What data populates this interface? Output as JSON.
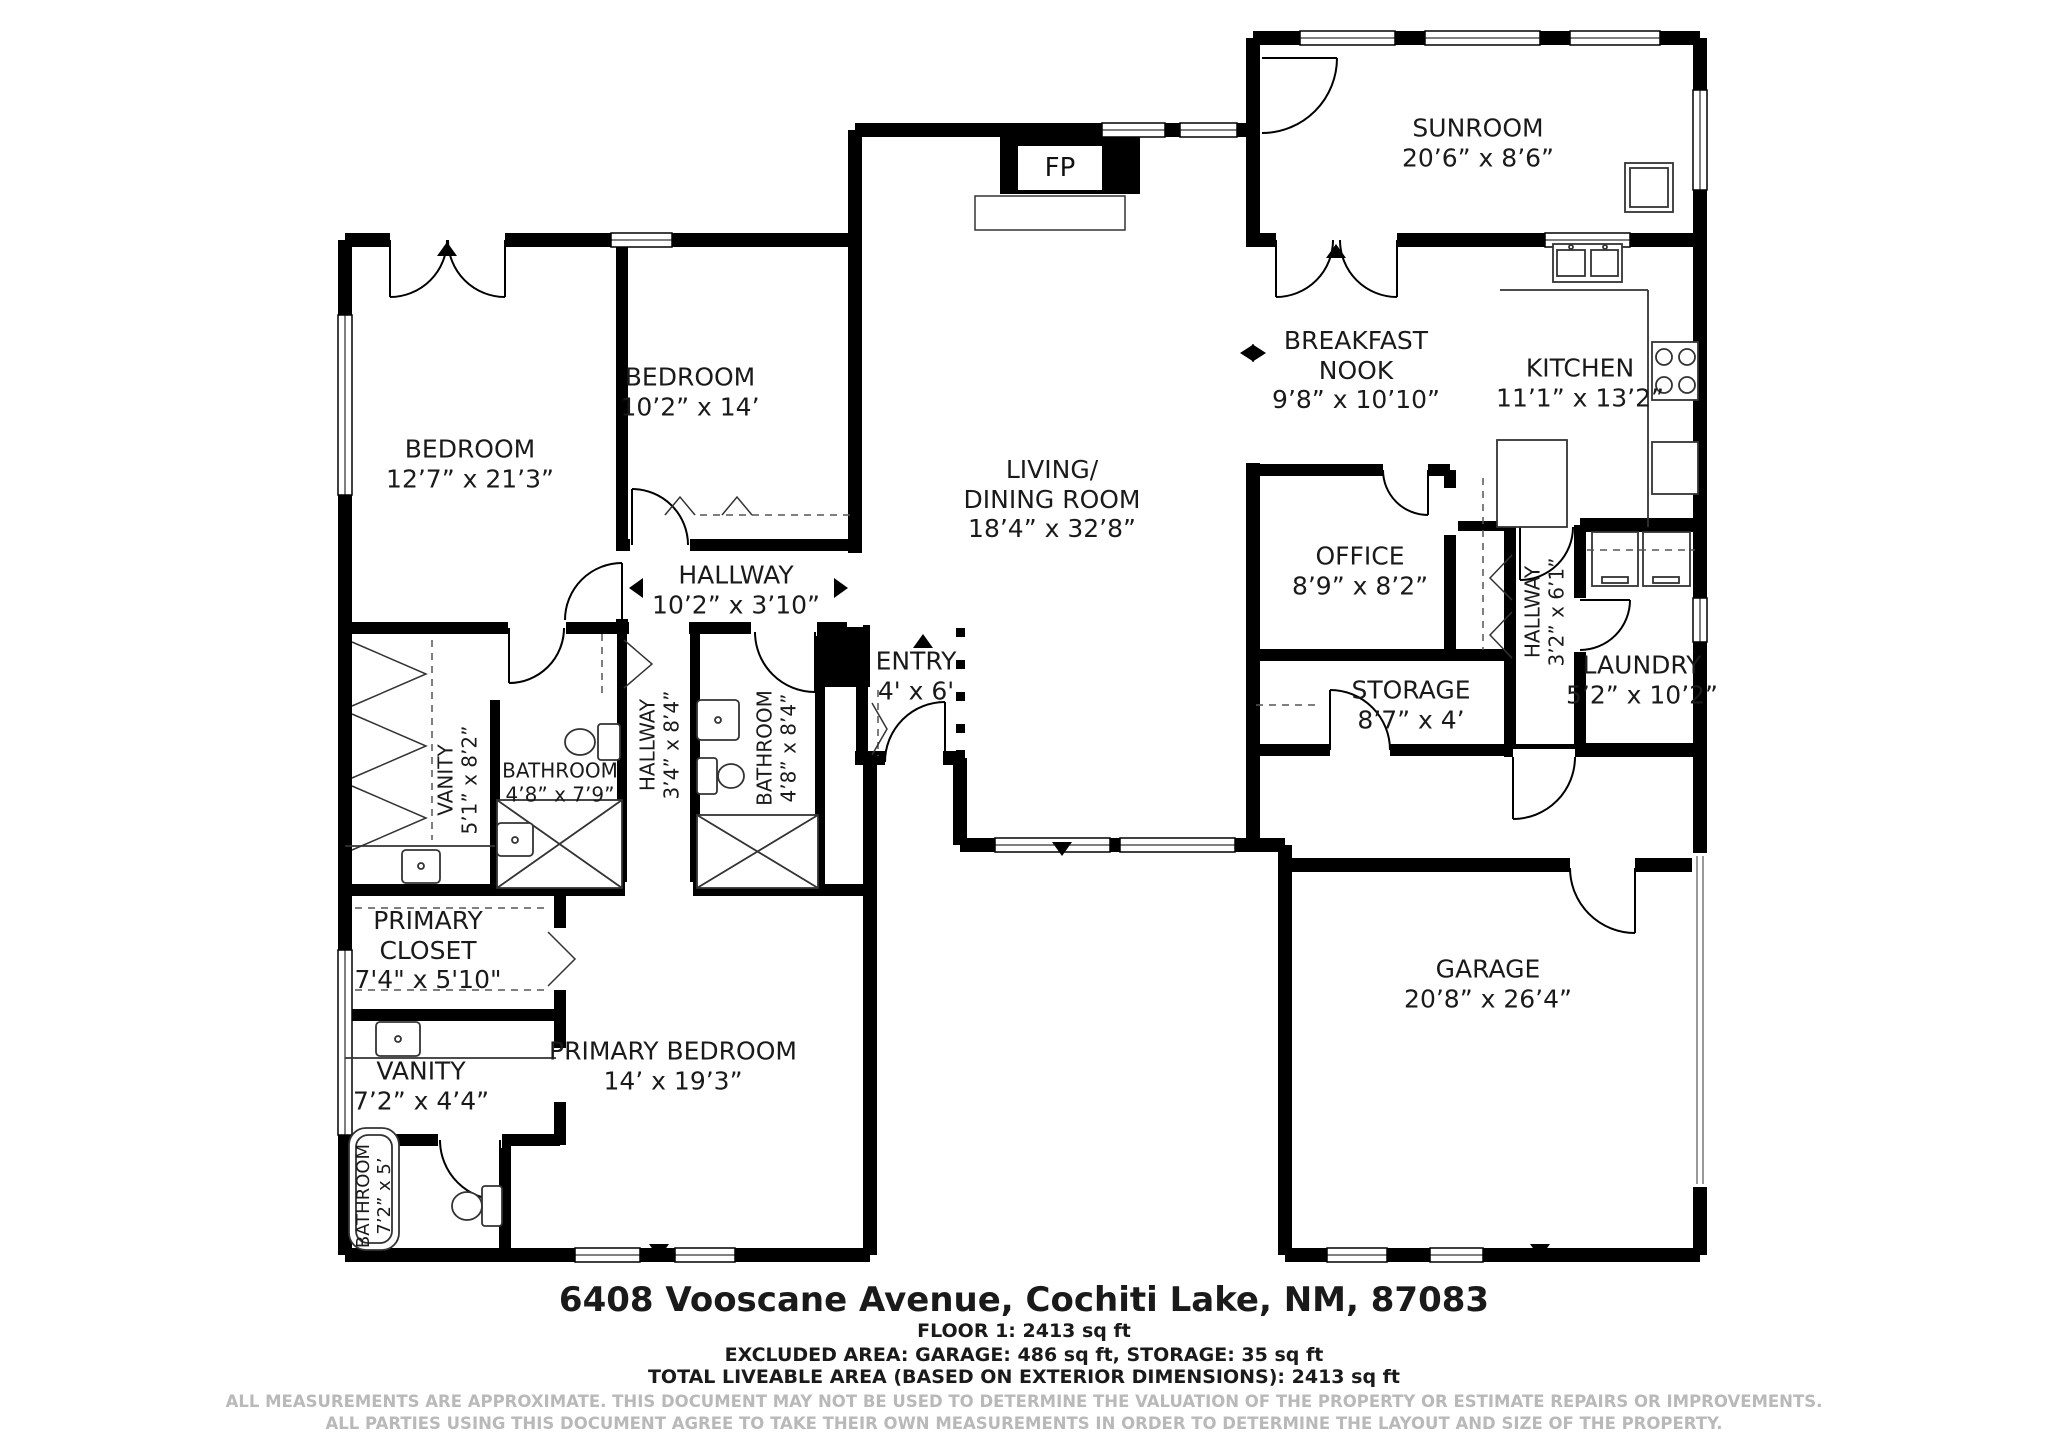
{
  "rooms": {
    "sunroom": {
      "line1": "SUNROOM",
      "dims": "20’6” x 8’6”"
    },
    "breakfast_nook": {
      "line1": "BREAKFAST",
      "line2": "NOOK",
      "dims": "9’8” x 10’10”"
    },
    "kitchen": {
      "line1": "KITCHEN",
      "dims": "11’1” x 13’2”"
    },
    "living_dining": {
      "line1": "LIVING/",
      "line2": "DINING ROOM",
      "dims": "18’4” x 32’8”"
    },
    "office": {
      "line1": "OFFICE",
      "dims": "8’9” x 8’2”"
    },
    "storage": {
      "line1": "STORAGE",
      "dims": "8’7” x 4’"
    },
    "hallway_right": {
      "line1": "HALLWAY",
      "dims": "3’2” x 6’1”"
    },
    "laundry": {
      "line1": "LAUNDRY",
      "dims": "5’2” x 10’2”"
    },
    "garage": {
      "line1": "GARAGE",
      "dims": "20’8” x 26’4”"
    },
    "bedroom_large": {
      "line1": "BEDROOM",
      "dims": "12’7” x 21’3”"
    },
    "bedroom_small": {
      "line1": "BEDROOM",
      "dims": "10’2” x 14’"
    },
    "hallway_main": {
      "line1": "HALLWAY",
      "dims": "10’2” x 3’10”"
    },
    "hallway_bath": {
      "line1": "HALLWAY",
      "dims": "3’4” x 8’4”"
    },
    "bathroom_hall": {
      "line1": "BATHROOM",
      "dims": "4’8” x 7’9”"
    },
    "bathroom_guest": {
      "line1": "BATHROOM",
      "dims": "4’8” x 8’4”"
    },
    "vanity_hall": {
      "line1": "VANITY",
      "dims": "5’1” x 8’2”"
    },
    "entry": {
      "line1": "ENTRY",
      "dims": "4' x 6'"
    },
    "primary_closet": {
      "line1": "PRIMARY",
      "line2": "CLOSET",
      "dims": "7'4\" x 5'10\""
    },
    "vanity_primary": {
      "line1": "VANITY",
      "dims": "7’2” x 4’4”"
    },
    "bathroom_primary": {
      "line1": "BATHROOM",
      "dims": "7’2” x 5’"
    },
    "primary_bedroom": {
      "line1": "PRIMARY BEDROOM",
      "dims": "14’ x 19’3”"
    }
  },
  "fireplace": {
    "label": "FP"
  },
  "footer": {
    "address": "6408 Vooscane Avenue, Cochiti Lake, NM, 87083",
    "floor_line": "FLOOR 1: 2413 sq ft",
    "excluded_line": "EXCLUDED AREA: GARAGE: 486 sq ft, STORAGE: 35 sq ft",
    "total_line": "TOTAL LIVEABLE AREA (BASED ON EXTERIOR DIMENSIONS): 2413 sq ft",
    "disclaimer1": "ALL MEASUREMENTS ARE APPROXIMATE. THIS DOCUMENT MAY NOT BE USED TO DETERMINE THE VALUATION OF THE PROPERTY OR ESTIMATE REPAIRS OR IMPROVEMENTS.",
    "disclaimer2": "ALL PARTIES USING THIS DOCUMENT AGREE TO TAKE THEIR OWN MEASUREMENTS IN ORDER TO DETERMINE THE LAYOUT AND SIZE OF THE PROPERTY."
  },
  "colors": {
    "wall": "#000000",
    "fixture": "#333333",
    "disclaimer": "#b9b9b9"
  }
}
